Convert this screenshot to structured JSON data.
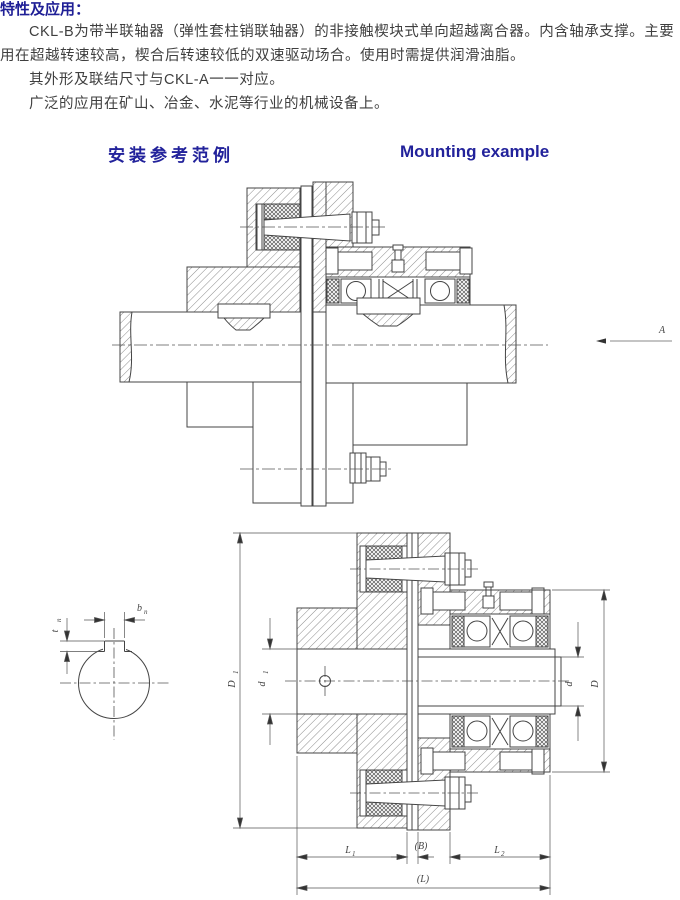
{
  "intro": {
    "title": "特性及应用：",
    "p1": "CKL-B为带半联轴器（弹性套柱销联轴器）的非接触楔块式单向超越离合器。内含轴承支撑。主要用在超越转速较高，楔合后转速较低的双速驱动场合。使用时需提供润滑油脂。",
    "p2": "其外形及联结尺寸与CKL-A一一对应。",
    "p3": "广泛的应用在矿山、冶金、水泥等行业的机械设备上。"
  },
  "section": {
    "title_zh": "安装参考范例",
    "title_en": "Mounting example"
  },
  "diagram1": {
    "view_arrow_label": "A"
  },
  "diagram2": {
    "labels": {
      "bn": {
        "base": "b",
        "sub": "n"
      },
      "tn": {
        "base": "t",
        "sub": "n"
      },
      "D1": {
        "base": "D",
        "sub": "1"
      },
      "d1": {
        "base": "d",
        "sub": "1"
      },
      "d": {
        "base": "d",
        "sub": ""
      },
      "D": {
        "base": "D",
        "sub": ""
      },
      "L1": {
        "base": "L",
        "sub": "1"
      },
      "B": {
        "base": "(B)",
        "sub": ""
      },
      "L2": {
        "base": "L",
        "sub": "2"
      },
      "L": {
        "base": "(L)",
        "sub": ""
      }
    }
  },
  "colors": {
    "heading_navy": "#22229b",
    "body_text": "#3f3f3f",
    "line": "#444444"
  }
}
